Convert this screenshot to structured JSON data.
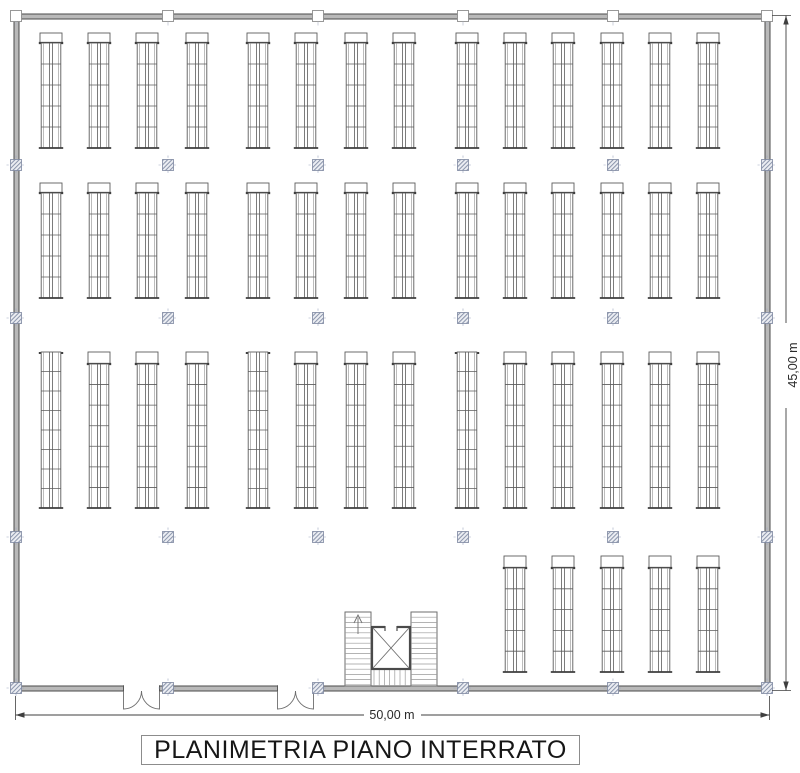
{
  "title_block": {
    "label": "PLANIMETRIA PIANO INTERRATO"
  },
  "dimensions": {
    "width_label": "50,00 m",
    "height_label": "45,00 m"
  },
  "colors": {
    "line": "#4a4a4a",
    "wall_fill": "#b9b9b9",
    "rack": "#5c5c5c",
    "rack_dark": "#3e3e3e",
    "rack_light": "#909090",
    "stair": "#6e6e6e",
    "stair_light": "#9a9a9a",
    "column_fill": "#eceef3",
    "column_hatch": "#8d97ad",
    "column_border": "#7d87a0",
    "cross": "#9aa3bd",
    "dim": "#3f3f3f",
    "dim_text": "#2a2a2a"
  },
  "plan": {
    "wall": {
      "x": 14,
      "y": 14,
      "w": 756,
      "h": 677,
      "t": 5
    },
    "rack_w": 22,
    "rack_x": [
      40,
      88,
      136,
      186,
      247,
      295,
      345,
      393,
      456,
      504,
      552,
      601,
      649,
      697
    ],
    "rows": [
      {
        "top": 33,
        "cap_h": 10,
        "bottom": 148,
        "cells": 5,
        "plain_cells": 6,
        "plain": [],
        "indices": [
          0,
          1,
          2,
          3,
          4,
          5,
          6,
          7,
          8,
          9,
          10,
          11,
          12,
          13
        ]
      },
      {
        "top": 183,
        "cap_h": 10,
        "bottom": 298,
        "cells": 5,
        "plain_cells": 6,
        "plain": [],
        "indices": [
          0,
          1,
          2,
          3,
          4,
          5,
          6,
          7,
          8,
          9,
          10,
          11,
          12,
          13
        ]
      },
      {
        "top": 352,
        "cap_h": 12,
        "bottom": 508,
        "cells": 7,
        "plain_cells": 8,
        "plain": [
          0,
          4,
          8
        ],
        "indices": [
          0,
          1,
          2,
          3,
          4,
          5,
          6,
          7,
          8,
          9,
          10,
          11,
          12,
          13
        ]
      },
      {
        "top": 556,
        "cap_h": 12,
        "bottom": 672,
        "cells": 5,
        "plain_cells": 6,
        "plain": [],
        "indices": [
          9,
          10,
          11,
          12,
          13
        ]
      }
    ],
    "columns": {
      "xs": [
        16,
        168,
        318,
        463,
        613,
        767
      ],
      "ys": [
        16,
        165,
        318,
        537,
        688
      ],
      "size": 11,
      "axis_ext": 4
    },
    "stair": {
      "x": 345,
      "y": 612,
      "w": 92,
      "h": 74,
      "flight_w": 26,
      "tread": 5.2,
      "lift": {
        "x": 372,
        "y": 627,
        "w": 38,
        "h": 42
      }
    },
    "doors": [
      {
        "x": 123.5,
        "w": 36
      },
      {
        "x": 277.5,
        "w": 36
      }
    ],
    "dim_bottom": {
      "y": 715,
      "x1": 15.5,
      "x2": 769.5,
      "gap1": 364,
      "gap2": 421,
      "text_x": 392
    },
    "dim_right": {
      "x": 786,
      "y1": 15.5,
      "y2": 690.5,
      "gap1": 323,
      "gap2": 408,
      "text_x": 797,
      "text_y": 365
    }
  }
}
